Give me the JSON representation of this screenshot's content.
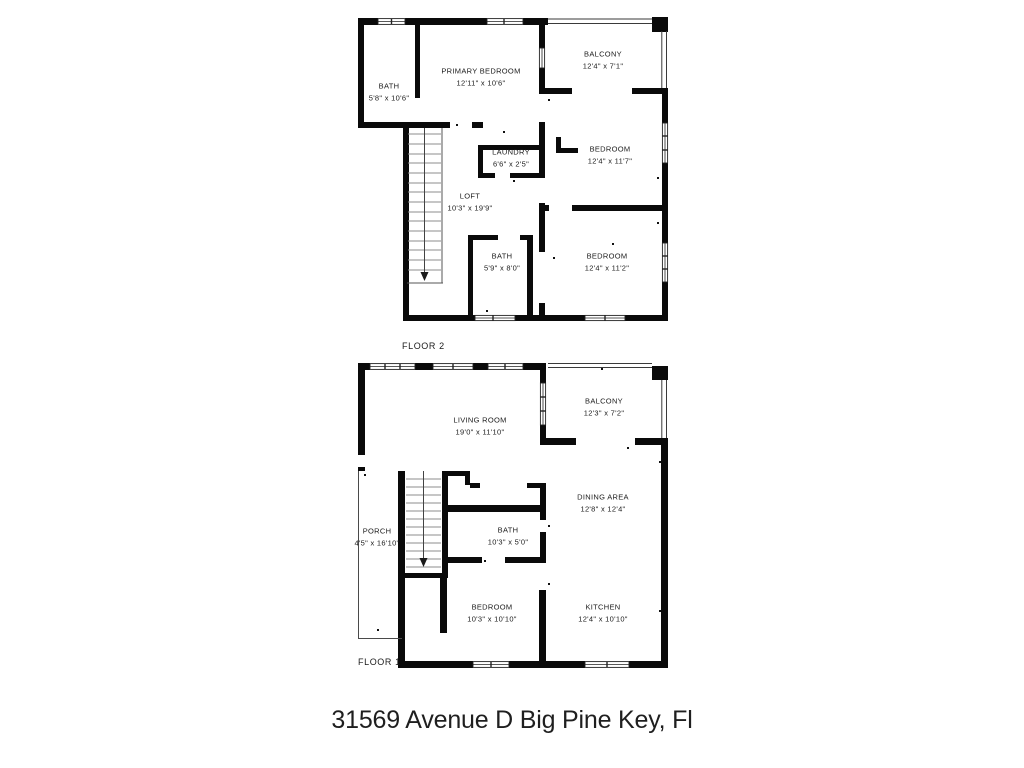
{
  "title": "31569 Avenue D Big Pine Key, Fl",
  "floor2": {
    "label": "FLOOR 2",
    "rooms": {
      "bath": {
        "name": "BATH",
        "dims": "5'8\" x 10'6\""
      },
      "primary_bedroom": {
        "name": "PRIMARY BEDROOM",
        "dims": "12'11\" x 10'6\""
      },
      "balcony": {
        "name": "BALCONY",
        "dims": "12'4\" x 7'1\""
      },
      "laundry": {
        "name": "LAUNDRY",
        "dims": "6'6\" x 2'5\""
      },
      "bedroom_upper": {
        "name": "BEDROOM",
        "dims": "12'4\" x 11'7\""
      },
      "loft": {
        "name": "LOFT",
        "dims": "10'3\" x 19'9\""
      },
      "bath_lower": {
        "name": "BATH",
        "dims": "5'9\" x 8'0\""
      },
      "bedroom_lower": {
        "name": "BEDROOM",
        "dims": "12'4\" x 11'2\""
      }
    }
  },
  "floor1": {
    "label": "FLOOR 1",
    "rooms": {
      "living_room": {
        "name": "LIVING ROOM",
        "dims": "19'0\" x 11'10\""
      },
      "balcony": {
        "name": "BALCONY",
        "dims": "12'3\" x 7'2\""
      },
      "dining_area": {
        "name": "DINING AREA",
        "dims": "12'8\" x 12'4\""
      },
      "porch": {
        "name": "PORCH",
        "dims": "4'5\" x 16'10\""
      },
      "bath": {
        "name": "BATH",
        "dims": "10'3\" x 5'0\""
      },
      "bedroom": {
        "name": "BEDROOM",
        "dims": "10'3\" x 10'10\""
      },
      "kitchen": {
        "name": "KITCHEN",
        "dims": "12'4\" x 10'10\""
      }
    }
  }
}
